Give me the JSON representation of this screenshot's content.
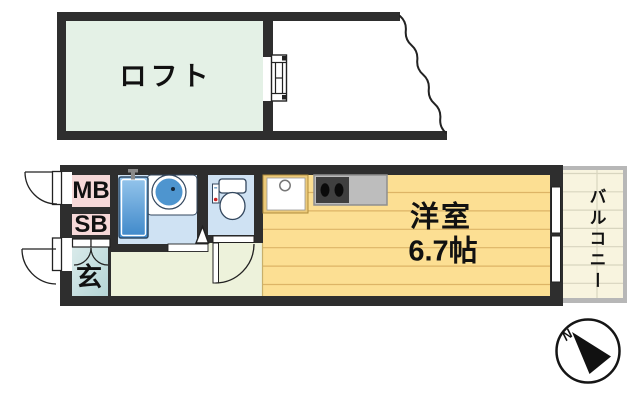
{
  "title": "apartment-floor-plan",
  "rooms": [
    {
      "id": "loft",
      "label": "ロフト",
      "floor_color": "#e4f1e6"
    },
    {
      "id": "meter-box",
      "label": "MB",
      "floor_color": "#f6d8d8"
    },
    {
      "id": "shoe-box",
      "label": "SB",
      "floor_color": "#f6d8d8"
    },
    {
      "id": "entrance",
      "label": "玄",
      "floor_color": "#cfe3e3"
    },
    {
      "id": "bathroom",
      "floor_color": "#cfe2f3"
    },
    {
      "id": "toilet",
      "floor_color": "#cfe2f3"
    },
    {
      "id": "hallway",
      "floor_color": "#edf2db"
    },
    {
      "id": "western-room",
      "label": "洋室",
      "size": "6.7帖",
      "floor_color": "#fcdf93"
    },
    {
      "id": "balcony",
      "label": "バルコニー",
      "floor_color": "#f8f4df"
    }
  ],
  "compass": {
    "north_label": "N"
  },
  "colors": {
    "wall": "#2e2e2e",
    "tub_blue": "#4c93d0",
    "floor_line": "#ddb466",
    "balcony_frame": "#b7b7b7"
  }
}
